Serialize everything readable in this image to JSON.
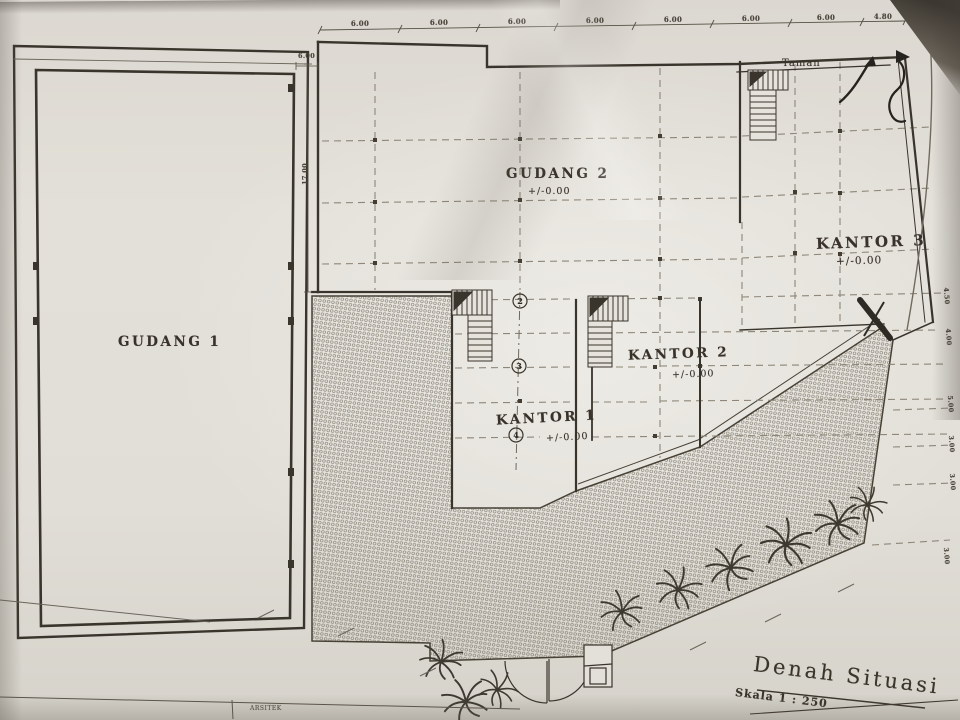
{
  "drawing": {
    "rooms": {
      "gudang1": {
        "name": "GUDANG 1"
      },
      "gudang2": {
        "name": "GUDANG 2",
        "level": "+/-0.00"
      },
      "kantor1": {
        "name": "KANTOR 1",
        "level": "+/-0.00"
      },
      "kantor2": {
        "name": "KANTOR 2",
        "level": "+/-0.00"
      },
      "kantor3": {
        "name": "KANTOR 3",
        "level": "+/-0.00"
      },
      "taman": {
        "name": "Taman"
      }
    },
    "grid_bubbles": [
      "2",
      "3",
      "4"
    ],
    "dimensions": {
      "top": [
        "6.00",
        "6.00",
        "6.00",
        "6.00",
        "6.00",
        "6.00",
        "6.00",
        "4.80"
      ],
      "left_gap": "6.00",
      "left_height": "17.00",
      "right": [
        "4.50",
        "4.00",
        "5.00",
        "3.00",
        "3.00",
        "3.00"
      ]
    },
    "title": {
      "name": "Denah Situasi",
      "scale": "Skala 1 : 250"
    },
    "footer": {
      "strip_label": "ARSITEK"
    },
    "colors": {
      "paper": "#dfdcd5",
      "ink": "#39342c",
      "dash": "#8d8679",
      "pen": "#26231f"
    }
  }
}
